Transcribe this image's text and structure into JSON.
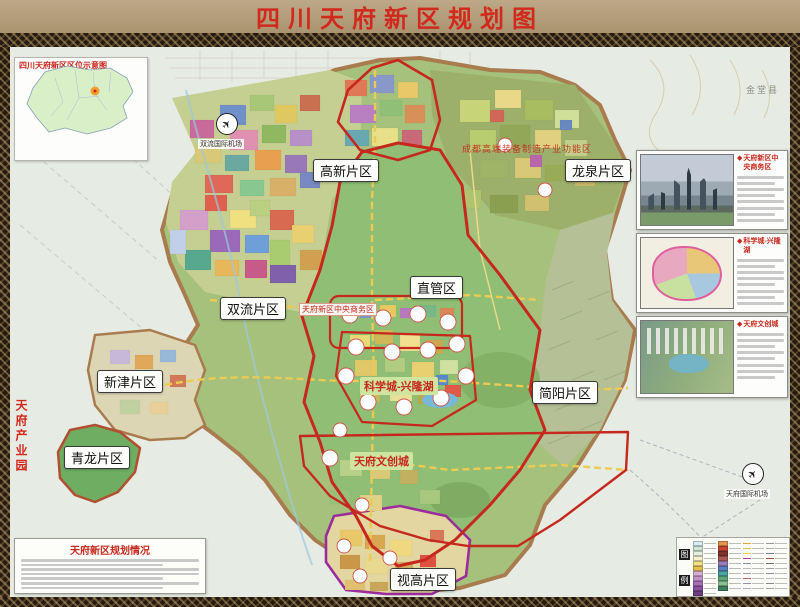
{
  "title": "四川天府新区规划图",
  "ui": {
    "bullet": "◆",
    "plane": "✈"
  },
  "inset_map": {
    "title": "四川天府新区区位示意图"
  },
  "regions": [
    {
      "label": "高新片区"
    },
    {
      "label": "龙泉片区"
    },
    {
      "label": "双流片区"
    },
    {
      "label": "直管区"
    },
    {
      "label": "新津片区"
    },
    {
      "label": "简阳片区"
    },
    {
      "label": "青龙片区"
    },
    {
      "label": "视高片区"
    }
  ],
  "zones": {
    "cbd": "天府新区中央商务区",
    "equip": "成都高端装备制造产业功能区",
    "science": "科学城-兴隆湖",
    "wenchuang": "天府文创城",
    "industry_park": "天府产业园"
  },
  "airports": [
    {
      "label": "双流国际机场"
    },
    {
      "label": "天府国际机场"
    }
  ],
  "place_names": [
    {
      "label": "金堂县"
    }
  ],
  "insets": [
    {
      "title": "天府新区中央商务区"
    },
    {
      "title": "科学城-兴隆湖"
    },
    {
      "title": "天府文创城"
    }
  ],
  "info_box": {
    "title": "天府新区规划情况"
  },
  "legend": {
    "label_chars": [
      "图",
      "例"
    ],
    "column_types": [
      "fill",
      "fill",
      "line",
      "line"
    ],
    "columns": [
      [
        "#d9ecf2",
        "#cde6d8",
        "#e6f0dc",
        "#f6f0cf",
        "#f2e187",
        "#dfc050",
        "#d6aed6",
        "#c493c8",
        "#a86fb4",
        "#8a4f9e",
        "#6d3f82"
      ],
      [
        "#e2944a",
        "#c8442f",
        "#7e322c",
        "#aa5a55",
        "#9a7cb8",
        "#5a7cc0",
        "#4aa4a4",
        "#5aaa78",
        "#8cc092",
        "#3f7f5f"
      ],
      [
        "#e8a23c",
        "#d8c050",
        "#ecd24a",
        "#b23aa0",
        "#8890a0",
        "#b8bec6",
        "#98a0a8",
        "#c06060",
        "#8898a8",
        "#a8b0b8"
      ],
      [
        "#9098a0",
        "#a8b0b8",
        "#788088",
        "#b04838",
        "#687078",
        "#98a0a8",
        "#8890a0",
        "#b8c0c8",
        "#808890",
        "#a0a8b0"
      ]
    ],
    "accent_boundary_colors": {
      "tianfu_outer": "#a97c50",
      "district_red": "#c5281c",
      "shigao_purple": "#9b2d9b",
      "road_yellow": "#eccb52"
    }
  }
}
